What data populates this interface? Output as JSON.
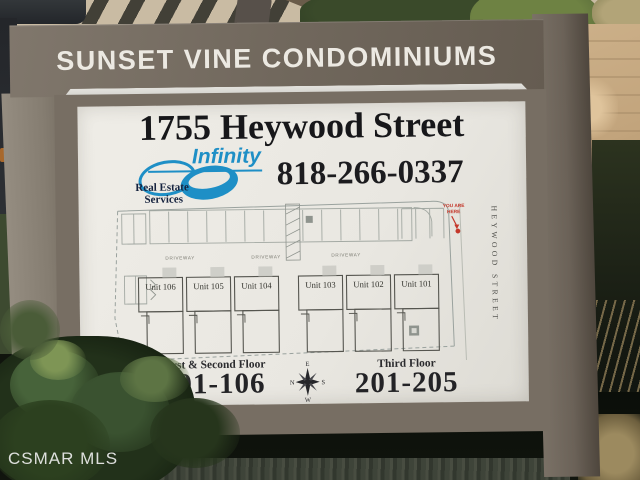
{
  "header": {
    "title": "SUNSET VINE CONDOMINIUMS"
  },
  "panel": {
    "address": "1755 Heywood Street",
    "phone": "818-266-0337",
    "logo": {
      "name": "Infinity",
      "line1": "Real Estate",
      "line2": "Services"
    },
    "floors": {
      "left_label": "First & Second Floor",
      "left_range": "101-106",
      "right_label": "Third Floor",
      "right_range": "201-205"
    }
  },
  "map": {
    "units": [
      "Unit 106",
      "Unit 105",
      "Unit 104",
      "Unit 103",
      "Unit 102",
      "Unit 101"
    ],
    "driveway": "DRIVEWAY",
    "you_are_here_line1": "YOU ARE",
    "you_are_here_line2": "HERE",
    "street": "HEYWOOD STREET"
  },
  "compass": {
    "top": "E",
    "left": "N",
    "right": "S",
    "bottom": "W"
  },
  "watermark": "CSMAR MLS",
  "colors": {
    "sign_brown": "#6e665b",
    "panel_white": "#ebe9e3",
    "logo_blue": "#1e8fc6",
    "marker_red": "#c4372a",
    "title_text": "#ece9e2"
  }
}
